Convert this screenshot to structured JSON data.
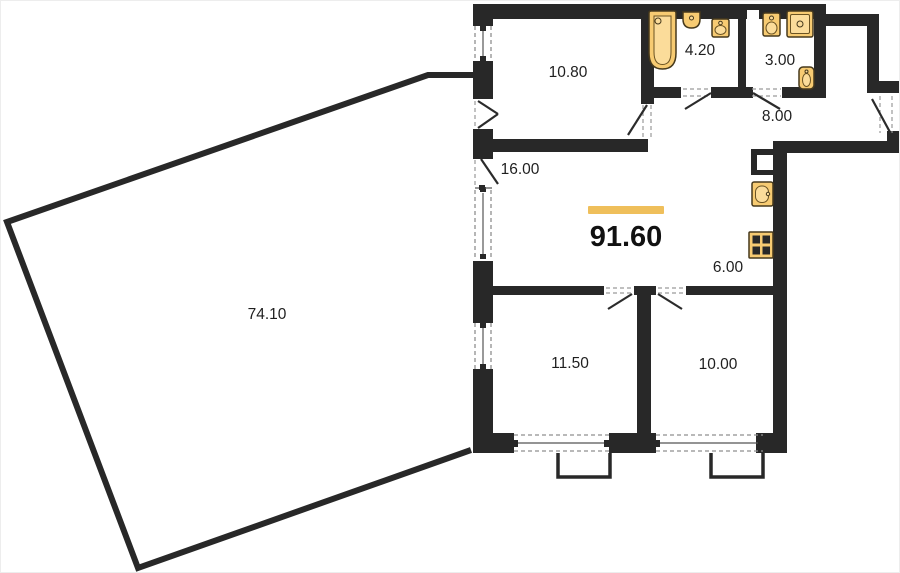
{
  "plan_title": "apartment-floor-plan",
  "total_area": {
    "value": "91.60"
  },
  "rooms": [
    {
      "name": "terrace",
      "area": "74.10"
    },
    {
      "name": "room-top",
      "area": "10.80"
    },
    {
      "name": "bathroom",
      "area": "4.20"
    },
    {
      "name": "toilet-room",
      "area": "3.00"
    },
    {
      "name": "hallway",
      "area": "8.00"
    },
    {
      "name": "living-room",
      "area": "16.00"
    },
    {
      "name": "kitchen",
      "area": "6.00"
    },
    {
      "name": "bedroom-left",
      "area": "11.50"
    },
    {
      "name": "bedroom-right",
      "area": "10.00"
    }
  ],
  "fixtures": [
    "bathtub-icon",
    "sink-icon",
    "sink-icon",
    "sink-icon",
    "washing-machine-icon",
    "toilet-icon",
    "kitchen-sink-icon",
    "stove-icon"
  ],
  "colors": {
    "wall": "#282828",
    "accent": "#EFBF5B",
    "fixture_fill": "#F7CB72",
    "fixture_fill_light": "#FBDC9A",
    "fixture_stroke": "#46391c",
    "label": "#1f1f1f",
    "background": "#ffffff"
  }
}
